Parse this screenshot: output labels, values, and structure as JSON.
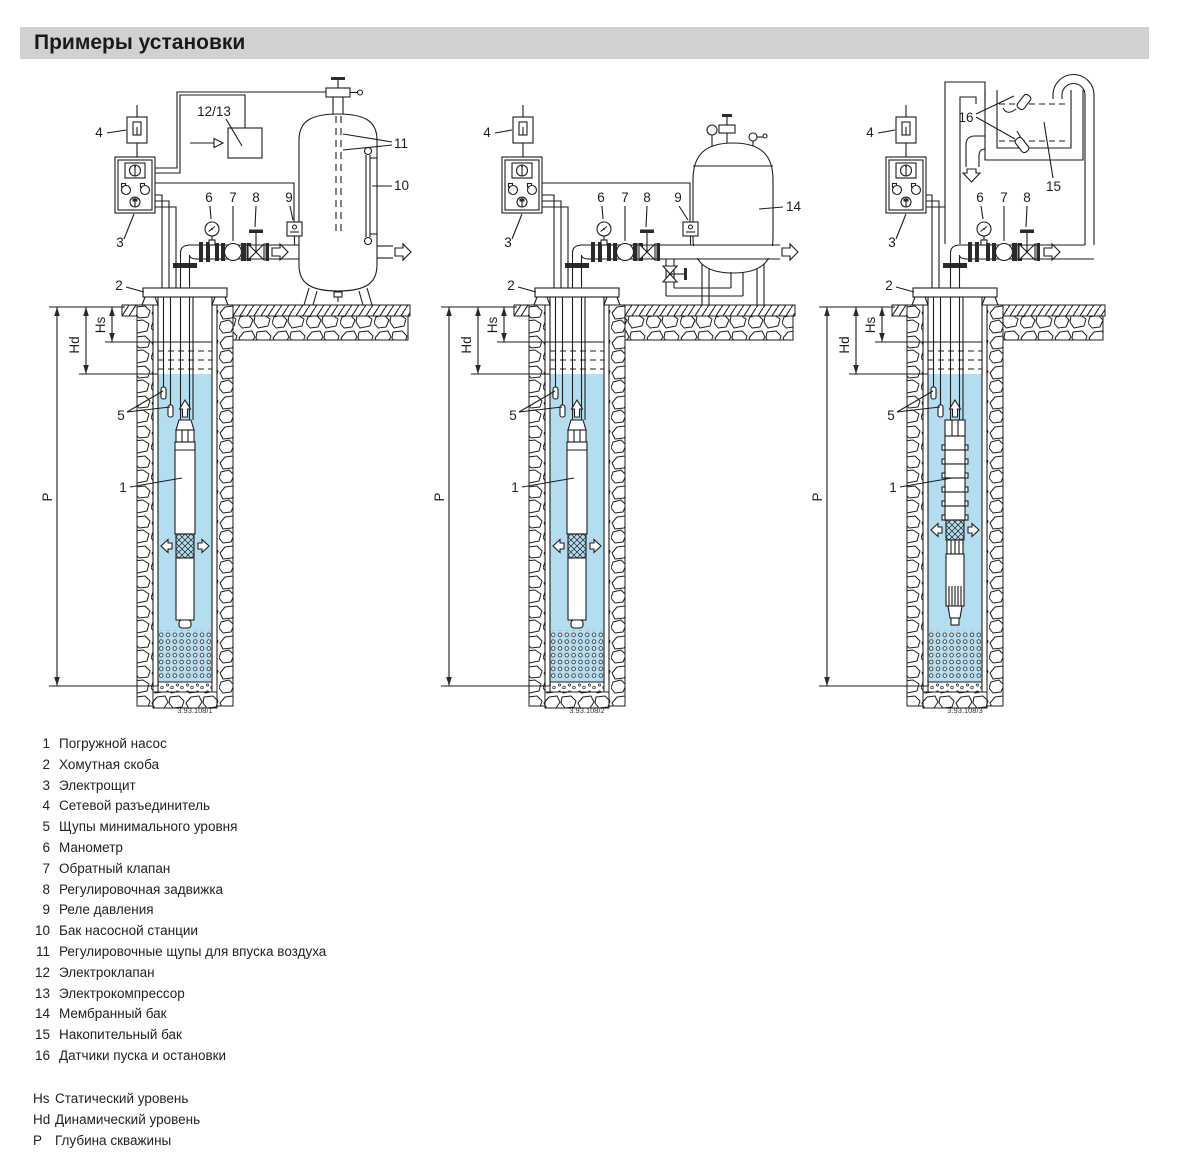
{
  "title": "Примеры установки",
  "colors": {
    "water": "#b5ddf0",
    "title_bg": "#d1d1d1",
    "line": "#1d1d1d"
  },
  "labels": {
    "n1": "1",
    "n2": "2",
    "n3": "3",
    "n4": "4",
    "n5": "5",
    "n6": "6",
    "n7": "7",
    "n8": "8",
    "n9": "9",
    "n10": "10",
    "n11": "11",
    "n12_13": "12/13",
    "n14": "14",
    "n15": "15",
    "n16": "16",
    "hs": "Hs",
    "hd": "Hd",
    "p": "P"
  },
  "diagrams": [
    {
      "name": "насосная станция с баком",
      "caption": "3.93.108/1"
    },
    {
      "name": "установка с мембранным баком",
      "caption": "3.93.108/2"
    },
    {
      "name": "установка с накопительным баком",
      "caption": "3.93.108/3"
    }
  ],
  "legend": [
    {
      "num": "1",
      "text": "Погружной насос"
    },
    {
      "num": "2",
      "text": "Хомутная скоба"
    },
    {
      "num": "3",
      "text": "Электрощит"
    },
    {
      "num": "4",
      "text": "Сетевой разъединитель"
    },
    {
      "num": "5",
      "text": "Щупы минимального уровня"
    },
    {
      "num": "6",
      "text": "Манометр"
    },
    {
      "num": "7",
      "text": "Обратный клапан"
    },
    {
      "num": "8",
      "text": "Регулировочная задвижка"
    },
    {
      "num": "9",
      "text": "Реле давления"
    },
    {
      "num": "10",
      "text": "Бак насосной станции"
    },
    {
      "num": "11",
      "text": "Регулировочные щупы для впуска воздуха"
    },
    {
      "num": "12",
      "text": "Электроклапан"
    },
    {
      "num": "13",
      "text": "Электрокомпрессор"
    },
    {
      "num": "14",
      "text": "Мембранный бак"
    },
    {
      "num": "15",
      "text": "Накопительный бак"
    },
    {
      "num": "16",
      "text": "Датчики пуска и остановки"
    }
  ],
  "level_defs": [
    {
      "sym": "Hs",
      "text": "Статический уровень"
    },
    {
      "sym": "Hd",
      "text": "Динамический уровень"
    },
    {
      "sym": "P",
      "text": "Глубина скважины"
    }
  ]
}
